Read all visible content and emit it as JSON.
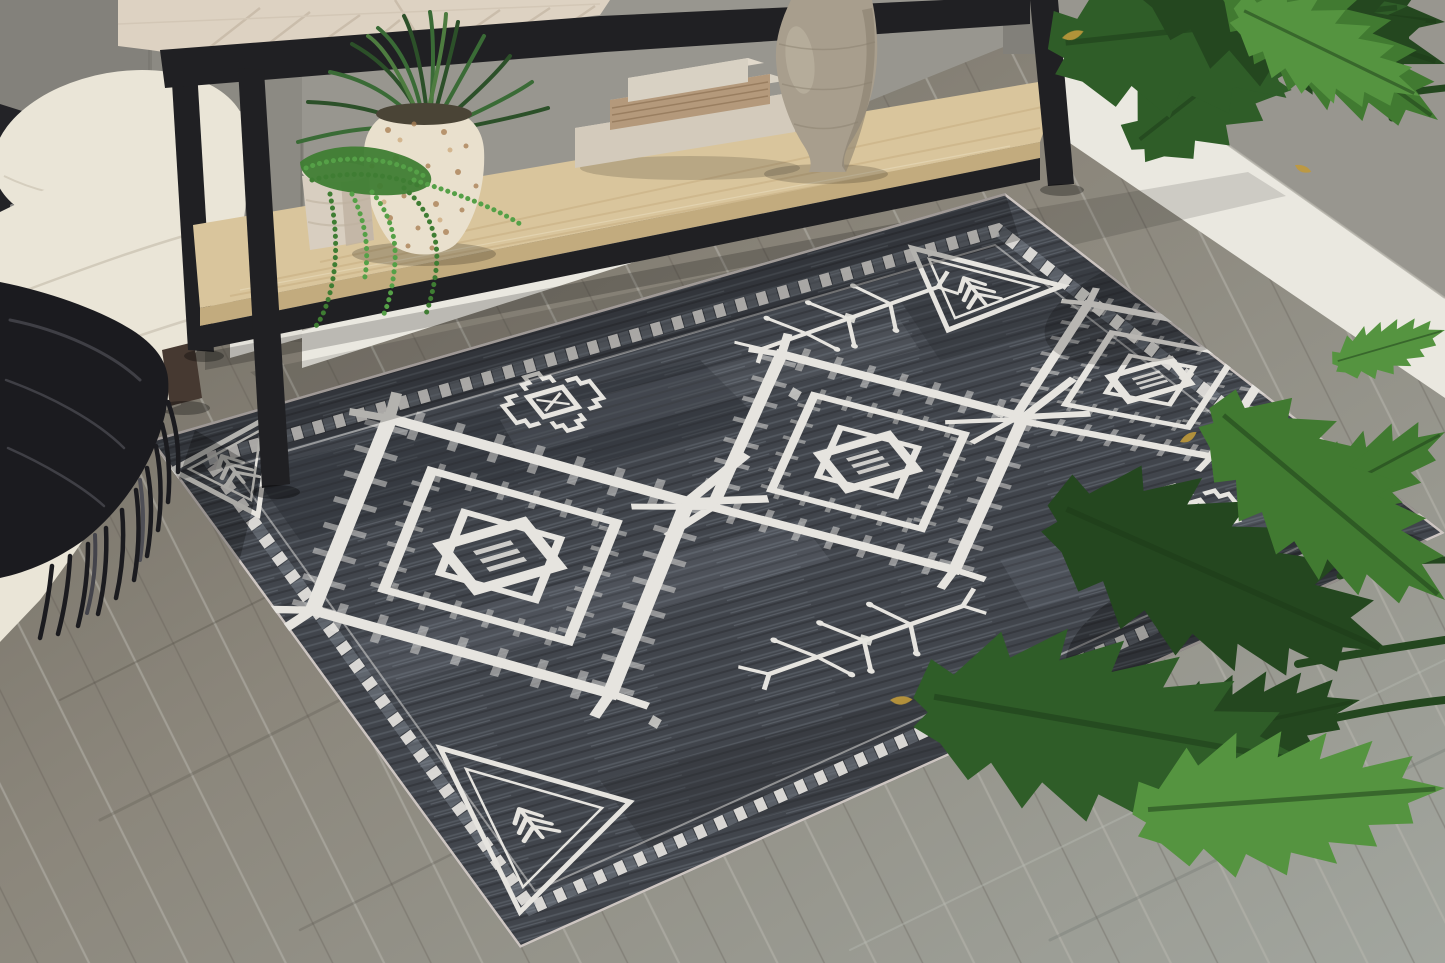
{
  "meta": {
    "type": "natural-image",
    "subject": "Distressed charcoal tribal-motif area rug styled in a living room corner",
    "no_visible_text": true
  },
  "colors": {
    "wall": "#98968f",
    "wall_dark": "#82807a",
    "baseboard": "#eae8e0",
    "floor_a": "#6b665c",
    "floor_b": "#8b867b",
    "floor_c": "#a2a69f",
    "plank_line": "#bab8af",
    "plank_dark": "#57534a",
    "rug_base": "#41454c",
    "rug_dark": "#2c2f35",
    "rug_streak": "#9aa3ae",
    "rug_white": "#e6e4df",
    "rug_binding": "#d5ccc7",
    "sofa": "#eae5d7",
    "sofa_shade": "#d8d2c2",
    "sofa_seam": "#cfc8b8",
    "sofa_foot": "#463931",
    "pillow": "#232327",
    "throw": "#1b1b1f",
    "throw_sheen": "#63636b",
    "metal": "#202023",
    "top_wood": "#ddd2c2",
    "top_wood_grain": "#c0b2a0",
    "shelf_wood": "#d9c59c",
    "shelf_edge": "#c2ab7e",
    "shelf_grain": "#c9b184",
    "shelf_grain_light": "#e8dcbc",
    "book_linen": "#d3cabb",
    "book_linen_top": "#e1d9cb",
    "book_wood": "#b4997b",
    "book_pages": "#8f7356",
    "book_top": "#d8d1c3",
    "pot_terrazzo": "#e9e0cd",
    "pot_speckle": "#a97f54",
    "pot_speckle_light": "#cdab7e",
    "pot_soil": "#4a4436",
    "small_pot": "#d8cec0",
    "small_pot_shade": "#bfb2a0",
    "vase": "#a89e8d",
    "vase_shade": "#8b8170",
    "vase_light": "#cfc5b4",
    "grass_dark": "#2c5029",
    "grass_green": "#3a6b36",
    "grass_alt": "#4e7c40",
    "pearls": "#55a047",
    "pearls_dark": "#3f7d33",
    "leaf_dark": "#24471f",
    "leaf_mid": "#2f5d28",
    "leaf_light": "#417a31",
    "leaf_bright": "#559440",
    "leaf_tip": "#c09a3b"
  },
  "scene": {
    "room": {
      "wall": "gray painted wall with corner and recess",
      "baseboard": "white baseboard, back wall and right wall planes",
      "floor": "weathered gray wood planks laid diagonally"
    },
    "rug": {
      "style": "distressed tribal / southwestern",
      "ground_color_key": "rug_base",
      "motif_color_key": "rug_white",
      "border": "double checkered diamond band with thin inner line and pale edge binding",
      "motifs": {
        "large_diamond_medallions": 3,
        "corner_triangles_with_tree_glyph": 3,
        "branch_snowflake_motifs": 2,
        "stepped_cross_motifs": 2,
        "small_diamond_accents": 3
      }
    },
    "furniture": {
      "sofa": "cream textured sofa arm with rolled back cushion, dark wood foot",
      "accent_pillow": "black pillow with white speckles, edge of frame",
      "throw": "black fringed throw blanket draped over sofa arm",
      "console_table": "black metal frame console with whitewashed chevron top and light wood lower shelf"
    },
    "decor": {
      "decorative_books": 3,
      "terrazzo_pot_with_grass_plant": 1,
      "small_pot_with_string_of_pearls": 1,
      "ceramic_vase": "large taupe textured gourd vase",
      "philodendron_plant": "large split-leaf plant overhanging from the right"
    }
  }
}
